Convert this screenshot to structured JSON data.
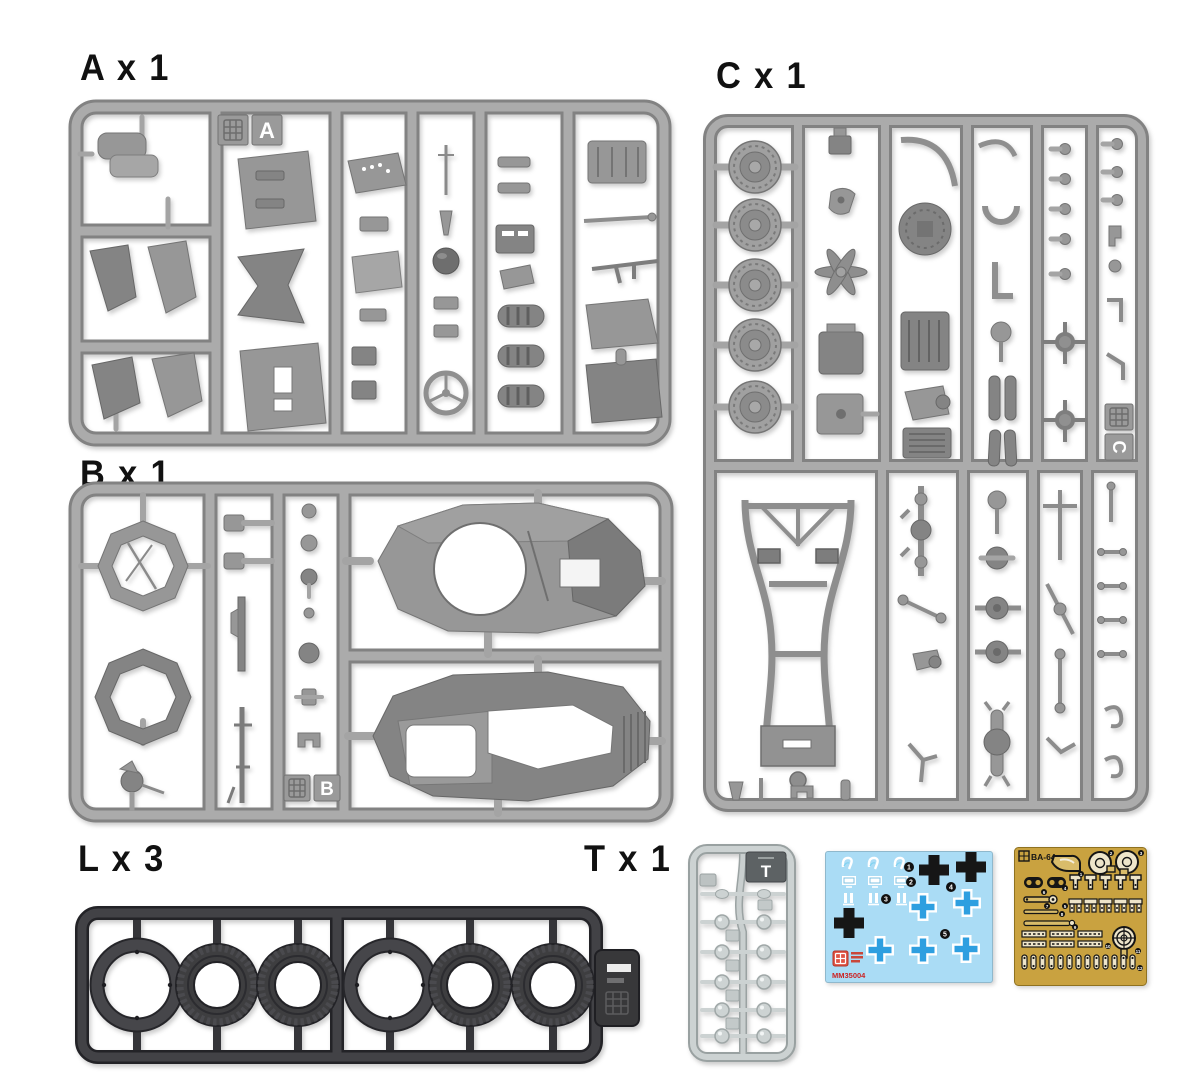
{
  "document": {
    "type": "model-kit-parts-diagram",
    "background": "#ffffff"
  },
  "sections": {
    "sprue_a": {
      "label": "A x 1",
      "tag": "A",
      "color": "#a9a9a9"
    },
    "sprue_b": {
      "label": "B x 1",
      "tag": "B",
      "color": "#a9a9a9"
    },
    "sprue_c": {
      "label": "C x 1",
      "tag": "C",
      "color": "#a9a9a9"
    },
    "sprue_l": {
      "label": "L x 3",
      "color": "#3c3c3e"
    },
    "sprue_t": {
      "label": "T x 1",
      "tag": "T",
      "color": "#c6cccc"
    },
    "decal_sheet": {
      "code": "MM35004",
      "background": "#aadcf5",
      "cross_blue": "#2e9fe0",
      "cross_black": "#161616",
      "code_color": "#cc2222",
      "callouts": [
        "1",
        "2",
        "3",
        "4",
        "5"
      ]
    },
    "photo_etch_fret": {
      "code": "BA-64",
      "color": "#c9a240",
      "callouts": [
        "1",
        "2",
        "3",
        "4",
        "5",
        "6",
        "7",
        "8",
        "9",
        "10",
        "11",
        "12"
      ]
    }
  }
}
